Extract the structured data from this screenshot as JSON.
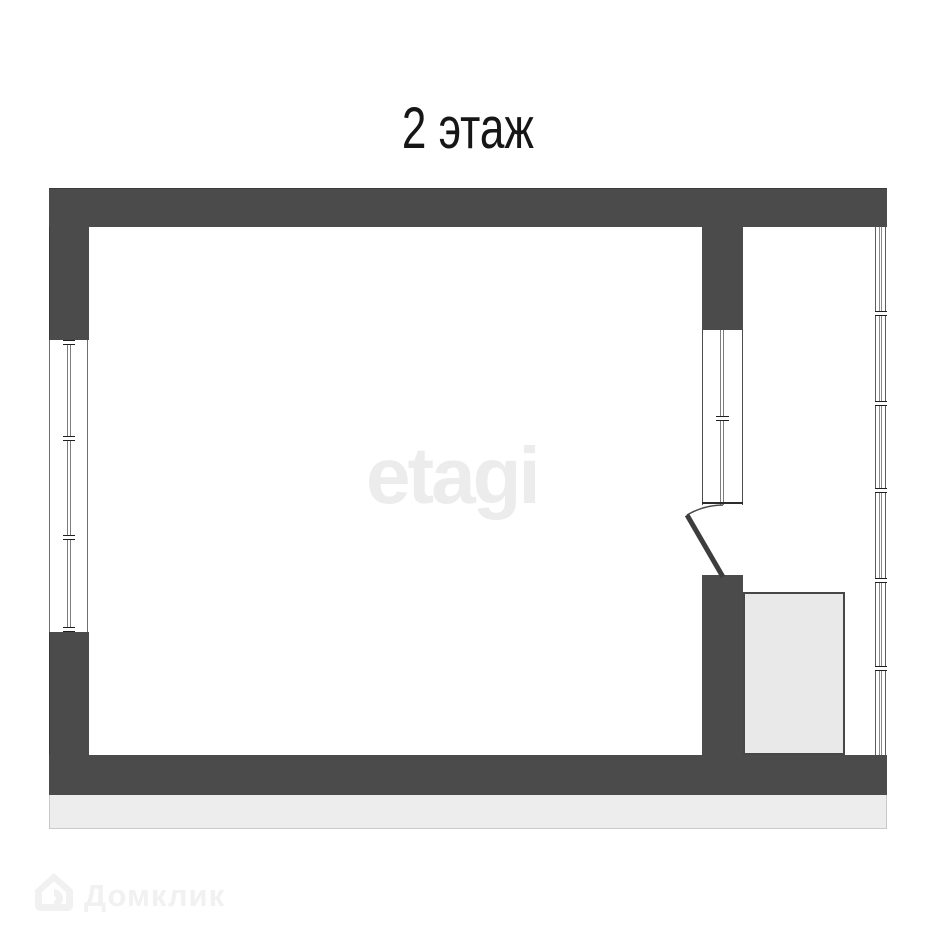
{
  "page": {
    "background_color": "#ffffff"
  },
  "header": {
    "floor_label": "2 этаж"
  },
  "floor_plan": {
    "wall_color": "#4b4b4b",
    "window_line_color": "#6e6e6e",
    "shaft_fill_color": "#e9e9e9",
    "base_strip_color": "#ededed",
    "elements": [
      "exterior-walls",
      "left-wall-window-3-panes",
      "right-glazed-wall-6-panes",
      "interior-partition-with-window",
      "door-with-swing-arc",
      "shaft-box-on-balcony",
      "base-strip"
    ]
  },
  "watermarks": {
    "center_logo_text": "etagi",
    "center_logo_color": "#ececec",
    "bottom_brand_text": "Домклик",
    "bottom_brand_color": "#f1f1f1",
    "bottom_brand_icon": "domclick-house-icon"
  }
}
